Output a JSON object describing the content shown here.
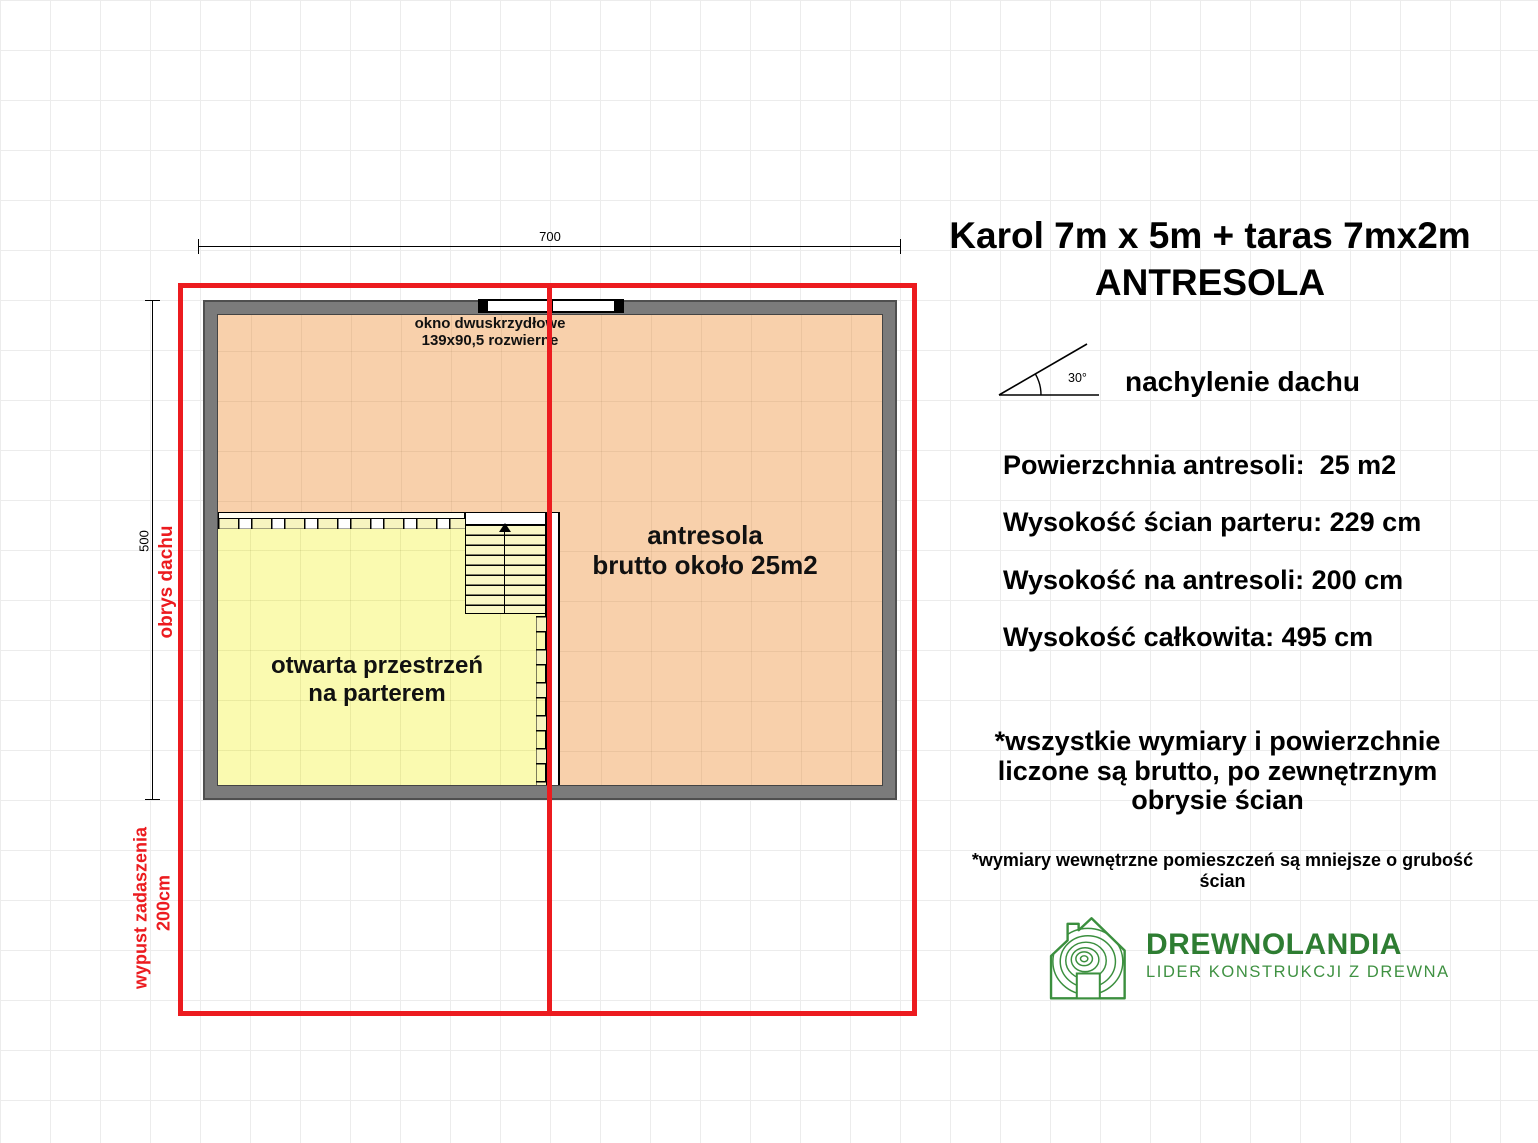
{
  "header": {
    "title_line1": "Karol 7m x 5m + taras 7mx2m",
    "title_line2": "ANTRESOLA"
  },
  "roof_pitch": {
    "angle_label": "30°",
    "caption": "nachylenie dachu"
  },
  "specs": [
    "Powierzchnia antresoli:  25 m2",
    "Wysokość ścian parteru: 229 cm",
    "Wysokość na antresoli: 200 cm",
    "Wysokość całkowita: 495 cm"
  ],
  "notes": {
    "primary": "*wszystkie wymiary i powierzchnie liczone są brutto, po zewnętrznym obrysie ścian",
    "secondary": "*wymiary wewnętrzne pomieszczeń są mniejsze o grubość ścian"
  },
  "plan": {
    "dim_top": "700",
    "dim_left": "500",
    "roof_outline_label": "obrys dachu",
    "overhang_label": "wypust zadaszenia",
    "overhang_value": "200cm",
    "window_label_line1": "okno dwuskrzydłowe",
    "window_label_line2": "139x90,5 rozwierne",
    "mezzanine_label_line1": "antresola",
    "mezzanine_label_line2": "brutto około 25m2",
    "open_space_label_line1": "otwarta przestrzeń",
    "open_space_label_line2": "na parterem"
  },
  "logo": {
    "name": "DREWNOLANDIA",
    "tagline": "LIDER KONSTRUKCJI Z DREWNA"
  },
  "colors": {
    "roof_outline_red": "#ec1b1f",
    "wall_gray": "#7b7b7b",
    "mezzanine_fill": "#f8d0ab",
    "open_space_fill": "#fafab0",
    "logo_green_dark": "#2e7d32",
    "logo_green_light": "#3f9142"
  }
}
